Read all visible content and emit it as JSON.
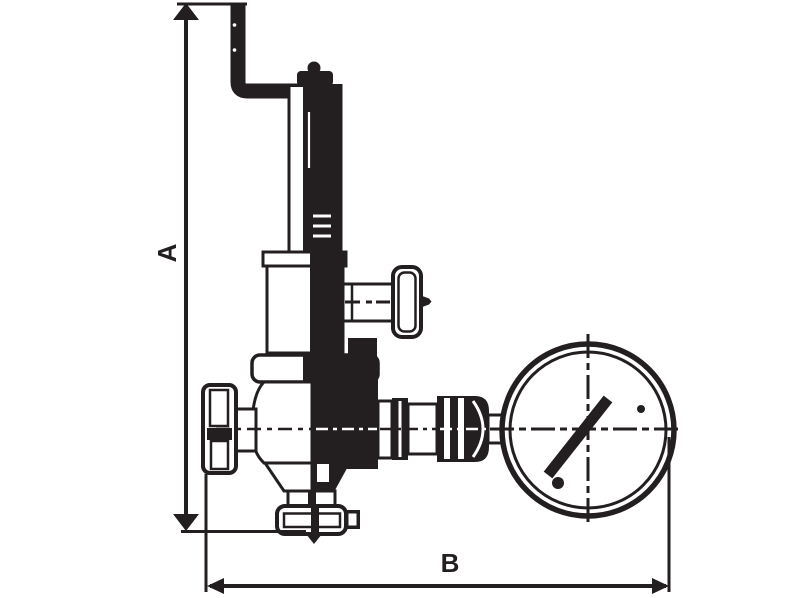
{
  "colors": {
    "ink": "#231f20",
    "bg": "#ffffff"
  },
  "diagram": {
    "kind": "technical-line-drawing",
    "subject": "relief valve with elbow pipe, spring housing, side adjusting handle, capped inlet and pressure gauge",
    "dimensions": {
      "height_label": "A",
      "width_label": "B"
    },
    "parts": [
      "inlet-pipe-elbow",
      "spring-housing",
      "bonnet-base",
      "adjusting-screw-handle",
      "valve-body",
      "inlet-cap",
      "outlet-fitting",
      "bottom-union",
      "pressure-gauge",
      "gauge-needle",
      "center-axis-line"
    ]
  }
}
